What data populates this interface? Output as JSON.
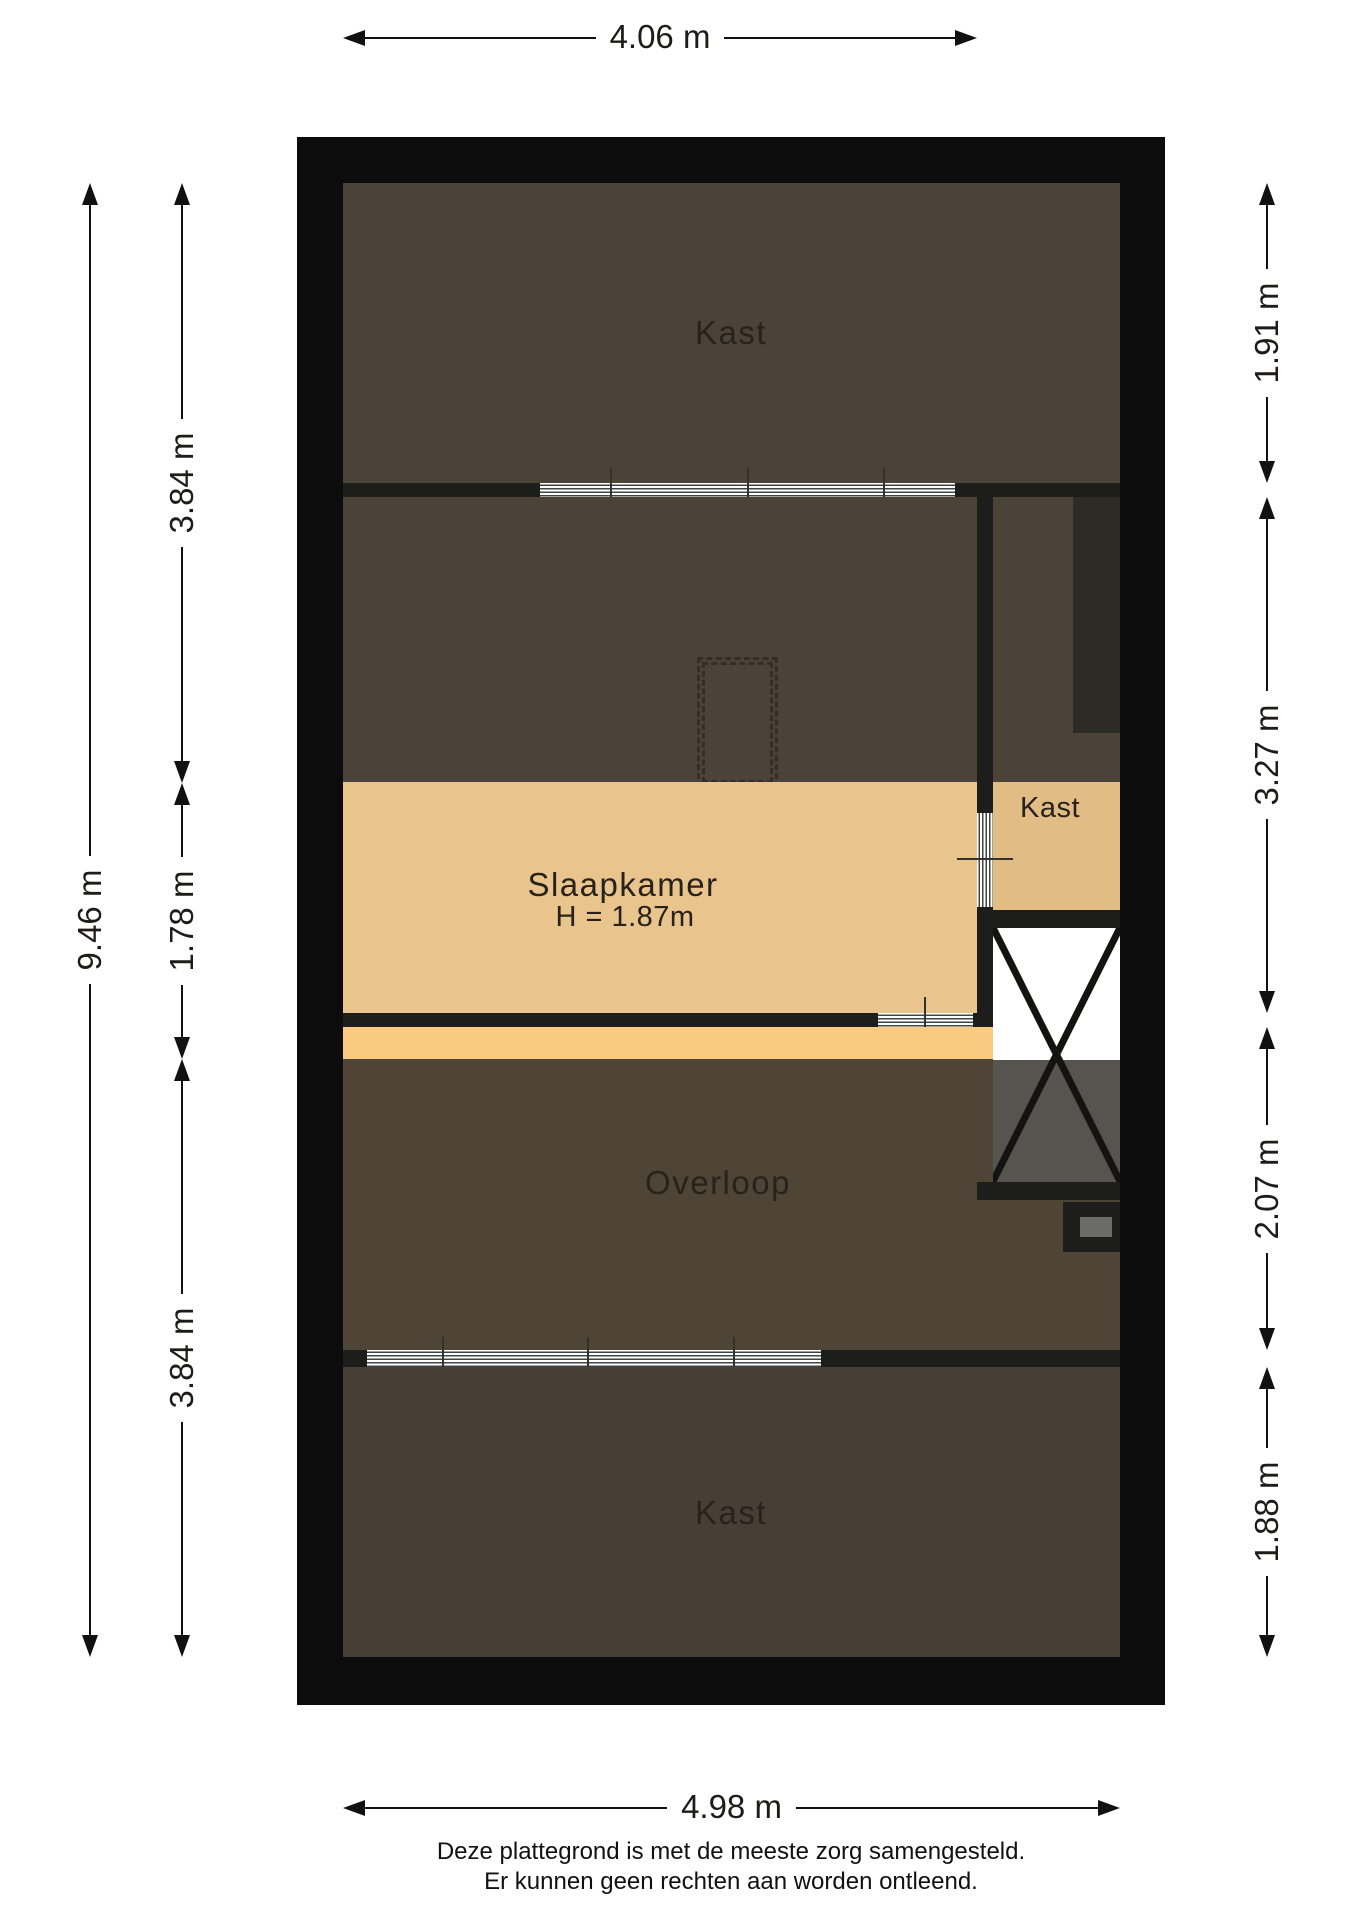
{
  "plan": {
    "rooms": {
      "kast_top": {
        "label": "Kast"
      },
      "slaapkamer": {
        "label": "Slaapkamer",
        "height_note": "H = 1.87m"
      },
      "kast_right": {
        "label": "Kast"
      },
      "overloop": {
        "label": "Overloop"
      },
      "kast_bottom": {
        "label": "Kast"
      }
    },
    "dimensions": {
      "top": {
        "label": "4.06 m"
      },
      "bottom": {
        "label": "4.98 m"
      },
      "left_outer": {
        "label": "9.46 m"
      },
      "left_inner": [
        {
          "label": "3.84 m"
        },
        {
          "label": "1.78 m"
        },
        {
          "label": "3.84 m"
        }
      ],
      "right": [
        {
          "label": "1.91 m"
        },
        {
          "label": "3.27 m"
        },
        {
          "label": "2.07 m"
        },
        {
          "label": "1.88 m"
        }
      ]
    }
  },
  "footer": {
    "line1": "Deze plattegrond is met de meeste zorg samengesteld.",
    "line2": "Er kunnen geen rechten aan worden ontleend."
  },
  "colors": {
    "wall": "#0c0c0c",
    "inner-wall": "#1d1d1b",
    "room-dark": "#4b4238",
    "room-mid": "#4e4536",
    "room-dark2": "#473f35",
    "dark-strip": "#2c2b26",
    "floor-tan": "#e9c48c",
    "floor-tan2": "#e2bc85",
    "floor-light": "#f9ca80",
    "void-grey": "#56544f",
    "chimney-grey": "#6b6b68",
    "window-line": "#3f4447",
    "ink": "#1d1c1a"
  }
}
